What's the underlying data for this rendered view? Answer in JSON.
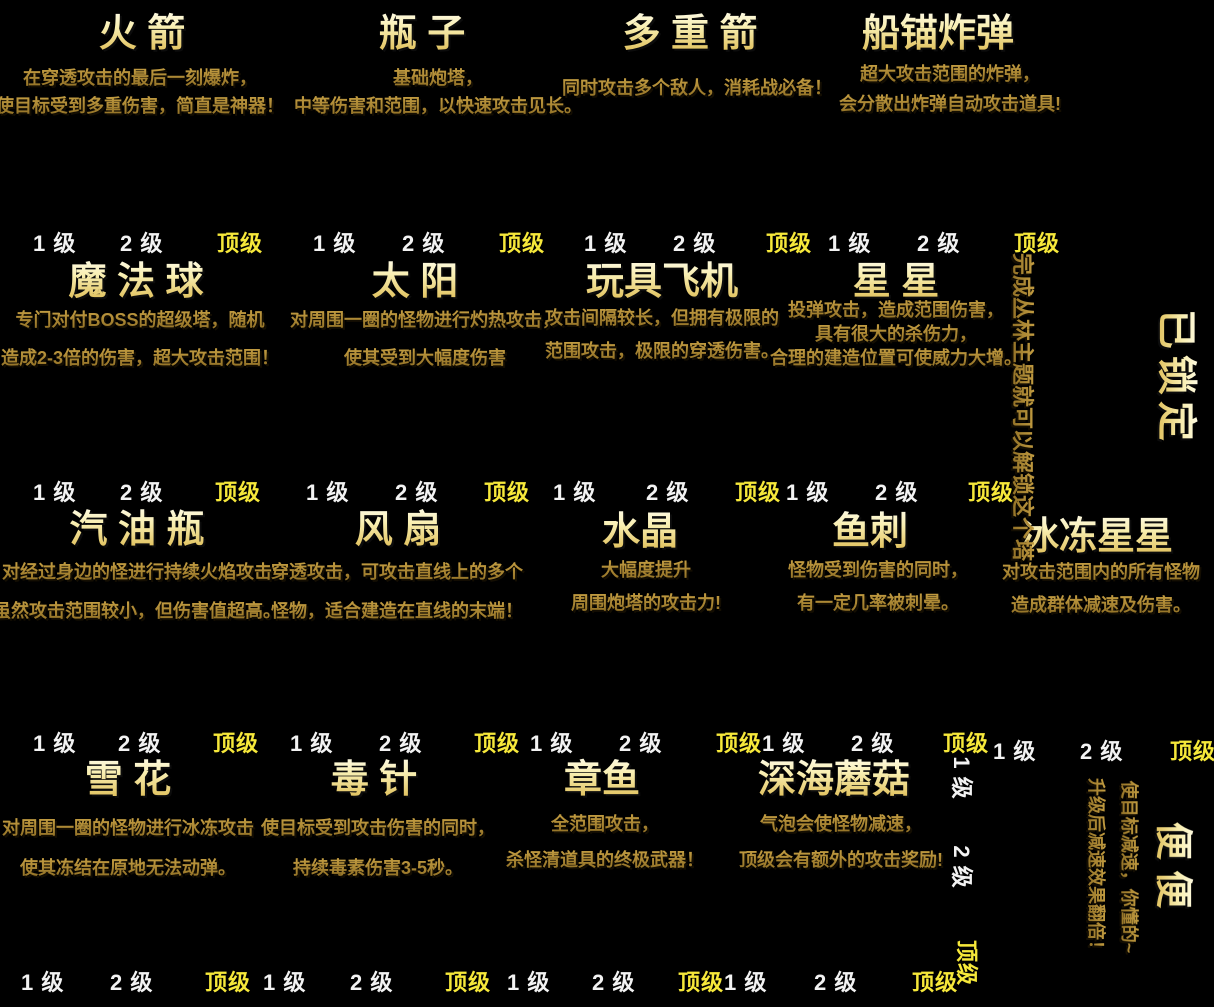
{
  "screen": "tower-encyclopedia",
  "levels": [
    "1 级",
    "2 级",
    "顶级"
  ],
  "locked": {
    "title": "已锁定",
    "hint": "完成丛林主题就可以解锁这个塔"
  },
  "colors": {
    "background": "#000000",
    "title_gold": "#f9efb2",
    "description_bronze": "#8a6a22",
    "level_label": "#f2f2f2",
    "level_top_label": "#f6e83a"
  },
  "towers": [
    {
      "id": "rocket",
      "name": "火 箭",
      "desc": [
        "在穿透攻击的最后一刻爆炸，",
        "使目标受到多重伤害，简直是神器！"
      ]
    },
    {
      "id": "bottle",
      "name": "瓶 子",
      "desc": [
        "基础炮塔，",
        "中等伤害和范围，以快速攻击见长。"
      ]
    },
    {
      "id": "multi-arrow",
      "name": "多 重 箭",
      "desc": [
        "同时攻击多个敌人，消耗战必备！"
      ]
    },
    {
      "id": "anchor-bomb",
      "name": "船锚炸弹",
      "desc": [
        "超大攻击范围的炸弹，",
        "会分散出炸弹自动攻击道具!"
      ]
    },
    {
      "id": "magic-ball",
      "name": "魔 法 球",
      "desc": [
        "专门对付BOSS的超级塔，随机",
        "造成2-3倍的伤害，超大攻击范围！"
      ]
    },
    {
      "id": "sun",
      "name": "太 阳",
      "desc": [
        "对周围一圈的怪物进行灼热攻击，",
        "使其受到大幅度伤害"
      ]
    },
    {
      "id": "toy-plane",
      "name": "玩具飞机",
      "desc": [
        "攻击间隔较长，但拥有极限的",
        "范围攻击，极限的穿透伤害。"
      ]
    },
    {
      "id": "star",
      "name": "星 星",
      "desc": [
        "投弹攻击，造成范围伤害，",
        "具有很大的杀伤力，",
        "合理的建造位置可使威力大增。"
      ]
    },
    {
      "id": "gasoline-bottle",
      "name": "汽 油 瓶",
      "desc": [
        "对经过身边的怪进行持续火焰攻击",
        "虽然攻击范围较小，但伤害值超高。"
      ]
    },
    {
      "id": "fan",
      "name": "风 扇",
      "desc": [
        "穿透攻击，可攻击直线上的多个",
        "怪物，适合建造在直线的末端！"
      ]
    },
    {
      "id": "crystal",
      "name": "水晶",
      "desc": [
        "大幅度提升",
        "周围炮塔的攻击力!"
      ]
    },
    {
      "id": "fishbone",
      "name": "鱼刺",
      "desc": [
        "怪物受到伤害的同时，",
        "有一定几率被刺晕。"
      ]
    },
    {
      "id": "frozen-star",
      "name": "冰冻星星",
      "desc": [
        "对攻击范围内的所有怪物",
        "造成群体减速及伤害。"
      ]
    },
    {
      "id": "snowflake",
      "name": "雪 花",
      "desc": [
        "对周围一圈的怪物进行冰冻攻击",
        "使其冻结在原地无法动弹。"
      ]
    },
    {
      "id": "poison-needle",
      "name": "毒 针",
      "desc": [
        "使目标受到攻击伤害的同时，",
        "持续毒素伤害3-5秒。"
      ]
    },
    {
      "id": "octopus",
      "name": "章鱼",
      "desc": [
        "全范围攻击，",
        "杀怪清道具的终极武器！"
      ]
    },
    {
      "id": "deep-sea-mushroom",
      "name": "深海蘑菇",
      "desc": [
        "气泡会使怪物减速，",
        "顶级会有额外的攻击奖励!"
      ]
    },
    {
      "id": "poop",
      "name": "便 便",
      "desc": [
        "使目标减速，你懂的~",
        "升级后减速效果翻倍！"
      ]
    }
  ]
}
